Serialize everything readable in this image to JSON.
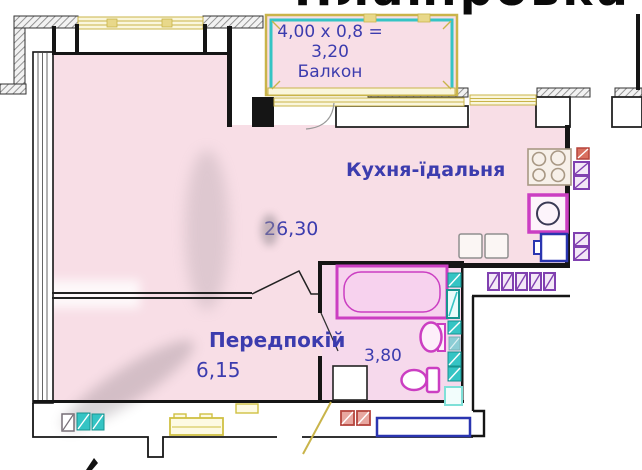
{
  "title": {
    "text": "Планіровка"
  },
  "balcony": {
    "calc_line": "4,00 x 0,8 =",
    "area": "3,20",
    "label": "Балкон"
  },
  "rooms": {
    "kitchen": {
      "label": "Кухня-їдальня",
      "area": "26,30"
    },
    "hallway": {
      "label": "Передпокій",
      "area": "6,15"
    },
    "bathroom": {
      "area": "3,80"
    }
  },
  "fixtures": [
    "stove-icon",
    "kitchen-sink-icon",
    "fridge-icon",
    "counter-icon",
    "bathtub-icon",
    "washbasin-icon",
    "toilet-icon",
    "washing-machine-icon",
    "ventilation-shaft-icon",
    "towel-rail-icon",
    "window-icon",
    "balcony-door-icon",
    "entry-door-swing-icon",
    "bench-icon"
  ],
  "colors": {
    "room_fill": "#f8dee6",
    "bath_fill": "#f6d9ec",
    "wall": "#151515",
    "label_text": "#3c3cae",
    "title": "#0a0a0a",
    "window_frame": "#c9b44a",
    "window_fill": "#faf6dc",
    "balcony_teal": "#35c4c4",
    "fixture_magenta": "#cb3ec2",
    "fixture_teal": "#35c4c4",
    "teal_dark": "#17948f",
    "vent_purple": "#8040b0",
    "vent_red": "#b5443c",
    "appliance_blue": "#2a35b0",
    "furniture_yellow": "#cfc043",
    "furniture_yellow_fill": "#fdfae3",
    "stove_gray": "#a89884"
  }
}
